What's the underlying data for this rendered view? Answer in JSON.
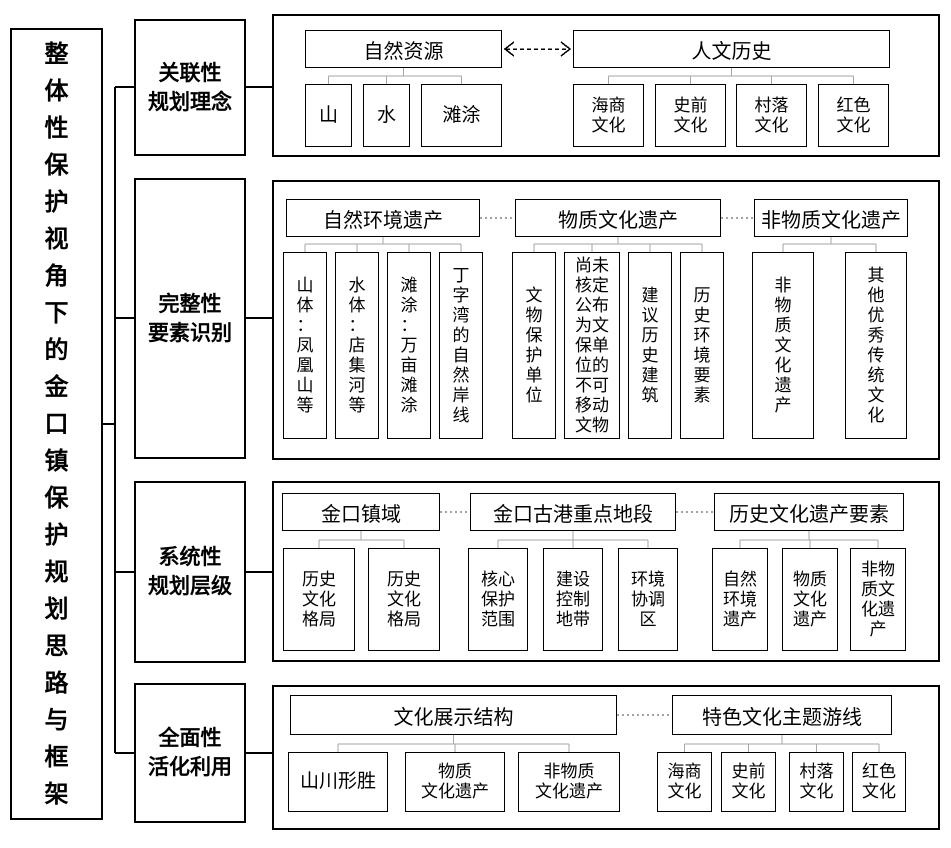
{
  "title": "整体性保护视角下的金口镇保护规划思路与框架",
  "sections": [
    {
      "label": "关联性\n规划理念"
    },
    {
      "label": "完整性\n要素识别"
    },
    {
      "label": "系统性\n规划层级"
    },
    {
      "label": "全面性\n活化利用"
    }
  ],
  "panels": [
    {
      "link_style": "dashed-double-arrow",
      "groups": [
        {
          "parent": "自然资源",
          "children": [
            "山",
            "水",
            "滩涂"
          ]
        },
        {
          "parent": "人文历史",
          "children": [
            "海商文化",
            "史前文化",
            "村落文化",
            "红色文化"
          ]
        }
      ]
    },
    {
      "link_style": "dotted",
      "groups": [
        {
          "parent": "自然环境遗产",
          "children": [
            "山体：凤凰山等",
            "水体：店集河等",
            "滩涂：万亩滩涂",
            "丁字湾的自然岸线"
          ]
        },
        {
          "parent": "物质文化遗产",
          "children": [
            "文物保护单位",
            "尚未核定公布为文保单位的不可移动文物",
            "建议历史建筑",
            "历史环境要素"
          ]
        },
        {
          "parent": "非物质文化遗产",
          "children": [
            "非物质文化遗产",
            "其他优秀传统文化"
          ]
        }
      ]
    },
    {
      "link_style": "dotted",
      "groups": [
        {
          "parent": "金口镇域",
          "children": [
            "历史文化格局",
            "历史文化格局"
          ]
        },
        {
          "parent": "金口古港重点地段",
          "children": [
            "核心保护范围",
            "建设控制地带",
            "环境协调区"
          ]
        },
        {
          "parent": "历史文化遗产要素",
          "children": [
            "自然环境遗产",
            "物质文化遗产",
            "非物质文化遗产"
          ]
        }
      ]
    },
    {
      "link_style": "dotted",
      "groups": [
        {
          "parent": "文化展示结构",
          "children": [
            "山川形胜",
            "物质\n文化遗产",
            "非物质\n文化遗产"
          ]
        },
        {
          "parent": "特色文化主题游线",
          "children": [
            "海商文化",
            "史前文化",
            "村落文化",
            "红色文化"
          ]
        }
      ]
    }
  ],
  "colors": {
    "box_border": "#000000",
    "elbow_connector": "#a6a6a6",
    "dotted_link": "#444444",
    "background": "#ffffff"
  }
}
